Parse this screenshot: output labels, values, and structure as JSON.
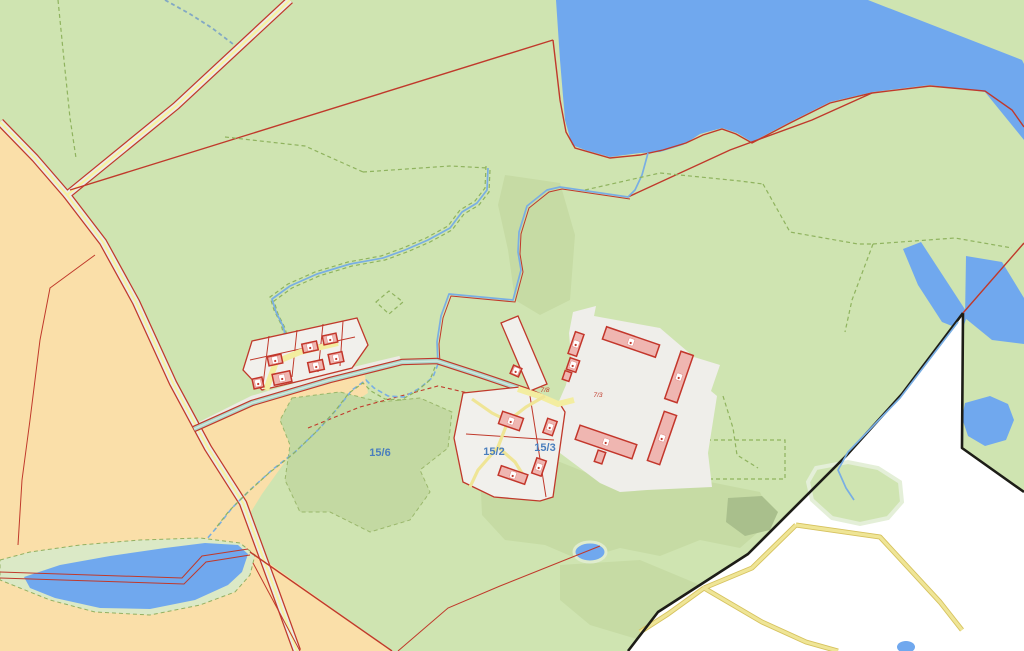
{
  "map": {
    "type": "cadastral-topographic-map",
    "labels": {
      "parcel_15_6": "15/6",
      "parcel_15_2": "15/2",
      "parcel_15_3": "15/3",
      "red_label_left": "7/8",
      "red_label_right": "7/3"
    },
    "palette": {
      "meadow_green": "#cfe4b1",
      "forest_green": "#c3d9a2",
      "field_orange": "#fadfa9",
      "water_blue": "#70a8ee",
      "parcel_white": "#f1f0ec",
      "nodata_white": "#ffffff",
      "building_pink": "#efb6b1",
      "boundary_red": "#c0392b",
      "road_yellow": "#f6f2a0",
      "canal_teal": "#aed6c9",
      "parcel_label_blue": "#4a7ebd",
      "area_boundary_black": "#1d1d17"
    },
    "features": [
      "north-lake",
      "southwest-pond",
      "farm-complex",
      "hamlet",
      "highway",
      "canal",
      "streams",
      "no-data-area",
      "field-tracks"
    ]
  }
}
